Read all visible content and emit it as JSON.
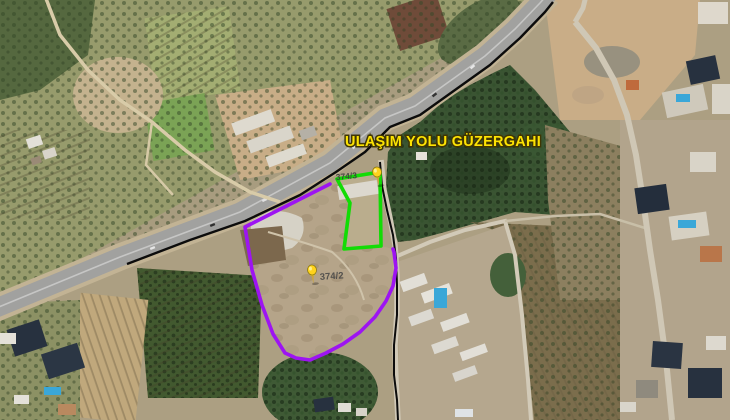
{
  "map": {
    "title": "ULAŞIM YOLU GÜZERGAHI",
    "pins": [
      {
        "id": "corridor-junction-pin",
        "label": "374/3"
      },
      {
        "id": "parcel-center-pin",
        "label": "374/2"
      }
    ],
    "colors": {
      "parcel_outline": "#9d14f2",
      "corridor_outline": "#12dc05",
      "route_line": "#0c0c0c",
      "title_text": "#fde303",
      "pin": "#ffd31c"
    }
  }
}
